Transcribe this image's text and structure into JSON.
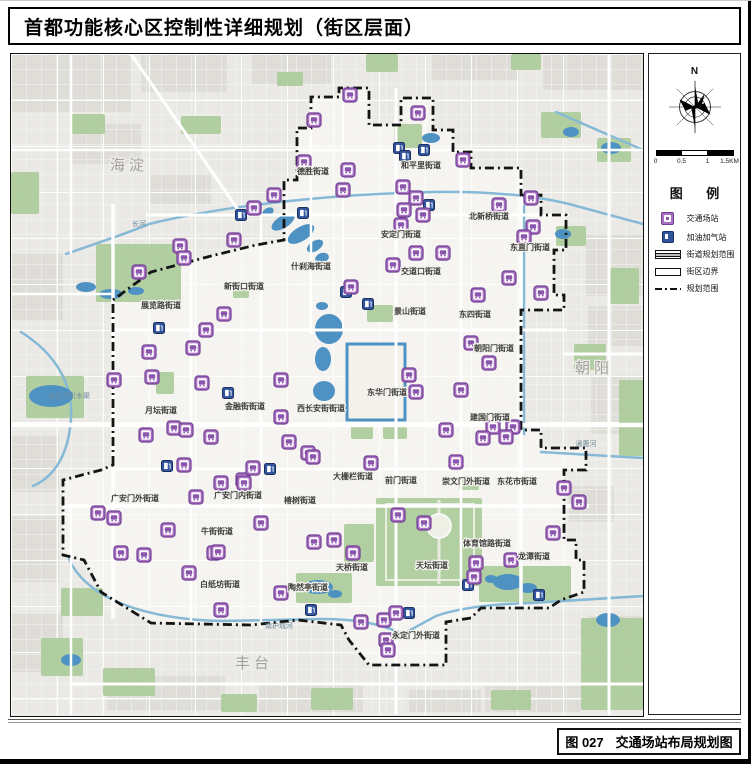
{
  "title": "首都功能核心区控制性详细规划（街区层面）",
  "caption": {
    "figure_no": "图 027",
    "figure_title": "交通场站布局规划图"
  },
  "panel": {
    "north_label": "N",
    "scale_labels": [
      "0",
      "0.5",
      "1",
      "1.5KM"
    ],
    "legend_title": "图 例",
    "legend_items": [
      {
        "swatch": "station",
        "label": "交通场站"
      },
      {
        "swatch": "gas",
        "label": "加油加气站"
      },
      {
        "swatch": "band",
        "label": "街道规划范围"
      },
      {
        "swatch": "outline",
        "label": "街区边界"
      },
      {
        "swatch": "dashdot",
        "label": "规划范围"
      }
    ]
  },
  "map": {
    "colors": {
      "bg": "#eae9e5",
      "inner": "#f5f4f1",
      "block": "#dfddd8",
      "park": "#abcb9b",
      "water": "#4e92c3",
      "river": "#85b9d6",
      "road": "#ffffff",
      "boundary": "#141414",
      "station_fill": "#a96fc0",
      "station_stroke": "#6f3f94",
      "station_glyph": "#8a56ab",
      "gas_fill": "#32549c",
      "gas_stroke": "#1b2f62",
      "street_label": "#3c3c38",
      "district_label": "#a3a19c",
      "water_label": "#6e8a9a"
    },
    "district_labels": [
      {
        "text": "海淀",
        "x": 118,
        "y": 116
      },
      {
        "text": "朝阳",
        "x": 583,
        "y": 319
      },
      {
        "text": "丰台",
        "x": 243,
        "y": 614
      }
    ],
    "water_labels": [
      {
        "text": "长河",
        "x": 128,
        "y": 172
      },
      {
        "text": "永定河引水渠",
        "x": 58,
        "y": 344
      },
      {
        "text": "通惠河",
        "x": 575,
        "y": 392
      },
      {
        "text": "南护城河",
        "x": 268,
        "y": 574
      }
    ],
    "street_labels": [
      {
        "text": "德胜街道",
        "x": 302,
        "y": 120
      },
      {
        "text": "和平里街道",
        "x": 410,
        "y": 114
      },
      {
        "text": "新街口街道",
        "x": 233,
        "y": 235
      },
      {
        "text": "安定门街道",
        "x": 390,
        "y": 183
      },
      {
        "text": "交道口街道",
        "x": 410,
        "y": 220
      },
      {
        "text": "北新桥街道",
        "x": 478,
        "y": 165
      },
      {
        "text": "东直门街道",
        "x": 519,
        "y": 196
      },
      {
        "text": "什刹海街道",
        "x": 300,
        "y": 215
      },
      {
        "text": "景山街道",
        "x": 399,
        "y": 260
      },
      {
        "text": "东四街道",
        "x": 464,
        "y": 263
      },
      {
        "text": "朝阳门街道",
        "x": 483,
        "y": 297
      },
      {
        "text": "东华门街道",
        "x": 376,
        "y": 341
      },
      {
        "text": "西长安街街道",
        "x": 310,
        "y": 357
      },
      {
        "text": "金融街街道",
        "x": 234,
        "y": 355
      },
      {
        "text": "月坛街道",
        "x": 150,
        "y": 359
      },
      {
        "text": "展览路街道",
        "x": 150,
        "y": 254
      },
      {
        "text": "建国门街道",
        "x": 479,
        "y": 366
      },
      {
        "text": "大栅栏街道",
        "x": 342,
        "y": 425
      },
      {
        "text": "前门街道",
        "x": 390,
        "y": 429
      },
      {
        "text": "崇文门外街道",
        "x": 455,
        "y": 430
      },
      {
        "text": "东花市街道",
        "x": 506,
        "y": 430
      },
      {
        "text": "广安门外街道",
        "x": 124,
        "y": 447
      },
      {
        "text": "广安门内街道",
        "x": 227,
        "y": 444
      },
      {
        "text": "椿树街道",
        "x": 289,
        "y": 449
      },
      {
        "text": "牛街街道",
        "x": 206,
        "y": 480
      },
      {
        "text": "陶然亭街道",
        "x": 297,
        "y": 536
      },
      {
        "text": "白纸坊街道",
        "x": 209,
        "y": 533
      },
      {
        "text": "天桥街道",
        "x": 341,
        "y": 516
      },
      {
        "text": "天坛街道",
        "x": 421,
        "y": 514
      },
      {
        "text": "体育馆路街道",
        "x": 476,
        "y": 492
      },
      {
        "text": "龙潭街道",
        "x": 523,
        "y": 505
      },
      {
        "text": "永定门外街道",
        "x": 405,
        "y": 584
      }
    ],
    "station_icons": [
      [
        339,
        41
      ],
      [
        303,
        66
      ],
      [
        407,
        59
      ],
      [
        293,
        108
      ],
      [
        337,
        116
      ],
      [
        452,
        106
      ],
      [
        488,
        151
      ],
      [
        520,
        144
      ],
      [
        522,
        173
      ],
      [
        513,
        183
      ],
      [
        498,
        224
      ],
      [
        530,
        239
      ],
      [
        263,
        141
      ],
      [
        243,
        154
      ],
      [
        223,
        186
      ],
      [
        169,
        192
      ],
      [
        173,
        204
      ],
      [
        128,
        218
      ],
      [
        213,
        260
      ],
      [
        195,
        276
      ],
      [
        182,
        294
      ],
      [
        138,
        298
      ],
      [
        141,
        323
      ],
      [
        103,
        326
      ],
      [
        191,
        329
      ],
      [
        332,
        136
      ],
      [
        392,
        133
      ],
      [
        405,
        144
      ],
      [
        393,
        156
      ],
      [
        412,
        161
      ],
      [
        390,
        171
      ],
      [
        405,
        199
      ],
      [
        432,
        199
      ],
      [
        382,
        211
      ],
      [
        340,
        233
      ],
      [
        467,
        241
      ],
      [
        460,
        289
      ],
      [
        478,
        309
      ],
      [
        450,
        336
      ],
      [
        435,
        376
      ],
      [
        482,
        373
      ],
      [
        502,
        373
      ],
      [
        472,
        384
      ],
      [
        495,
        383
      ],
      [
        270,
        326
      ],
      [
        398,
        321
      ],
      [
        405,
        338
      ],
      [
        270,
        363
      ],
      [
        297,
        399
      ],
      [
        302,
        403
      ],
      [
        135,
        381
      ],
      [
        163,
        374
      ],
      [
        175,
        376
      ],
      [
        200,
        383
      ],
      [
        278,
        388
      ],
      [
        173,
        411
      ],
      [
        210,
        429
      ],
      [
        232,
        426
      ],
      [
        185,
        443
      ],
      [
        87,
        459
      ],
      [
        103,
        464
      ],
      [
        157,
        476
      ],
      [
        110,
        499
      ],
      [
        133,
        501
      ],
      [
        203,
        499
      ],
      [
        242,
        414
      ],
      [
        233,
        429
      ],
      [
        250,
        469
      ],
      [
        207,
        498
      ],
      [
        178,
        519
      ],
      [
        210,
        556
      ],
      [
        270,
        539
      ],
      [
        303,
        488
      ],
      [
        323,
        486
      ],
      [
        342,
        499
      ],
      [
        360,
        409
      ],
      [
        387,
        461
      ],
      [
        413,
        469
      ],
      [
        445,
        408
      ],
      [
        553,
        434
      ],
      [
        568,
        448
      ],
      [
        542,
        479
      ],
      [
        500,
        506
      ],
      [
        465,
        509
      ],
      [
        463,
        523
      ],
      [
        350,
        568
      ],
      [
        373,
        566
      ],
      [
        385,
        559
      ],
      [
        375,
        586
      ],
      [
        377,
        596
      ]
    ],
    "gas_icons": [
      [
        230,
        161
      ],
      [
        292,
        159
      ],
      [
        388,
        94
      ],
      [
        394,
        102
      ],
      [
        413,
        96
      ],
      [
        418,
        151
      ],
      [
        148,
        274
      ],
      [
        217,
        339
      ],
      [
        156,
        412
      ],
      [
        259,
        415
      ],
      [
        335,
        238
      ],
      [
        357,
        250
      ],
      [
        300,
        556
      ],
      [
        398,
        559
      ],
      [
        457,
        531
      ],
      [
        528,
        541
      ]
    ],
    "boundary_path": "M 102,411 L 102,246 L 140,218 L 200,202 L 245,191 L 273,186 L 273,126 L 286,126 L 286,74 L 300,74 L 300,43 L 328,43 L 328,34 L 358,34 L 358,71 L 390,71 L 390,44 L 422,44 L 422,76 L 442,76 L 442,98 L 460,98 L 460,114 L 510,114 L 510,141 L 530,141 L 530,161 L 555,161 L 555,196 L 543,196 L 543,241 L 553,241 L 553,256 L 510,256 L 510,376 L 530,376 L 530,394 L 575,394 L 575,416 L 553,416 L 553,486 L 565,486 L 565,506 L 573,506 L 573,538 L 550,546 L 538,554 L 470,554 L 460,564 L 435,568 L 435,611 L 358,611 L 338,586 L 330,571 L 287,566 L 240,571 L 140,569 L 90,538 L 73,506 L 52,501 L 52,426 L 90,416 Z",
    "roads": [
      {
        "d": "M 0,371 H 632",
        "w": 4.5
      },
      {
        "d": "M 102,276 H 555",
        "w": 3
      },
      {
        "d": "M 52,452 H 578",
        "w": 3.5
      },
      {
        "d": "M 102,415 H 553",
        "w": 2.5
      },
      {
        "d": "M 135,161 H 558",
        "w": 3
      },
      {
        "d": "M 0,96 H 632",
        "w": 2.5
      },
      {
        "d": "M 0,240 H 102",
        "w": 2.5
      },
      {
        "d": "M 60,630 H 632",
        "w": 3
      },
      {
        "d": "M 553,300 H 632",
        "w": 3
      },
      {
        "d": "M 102,150 V 565",
        "w": 3.5
      },
      {
        "d": "M 510,114 V 556",
        "w": 3.5
      },
      {
        "d": "M 385,34 V 660",
        "w": 3
      },
      {
        "d": "M 250,160 V 575",
        "w": 2.5
      },
      {
        "d": "M 450,114 V 562",
        "w": 2.5
      },
      {
        "d": "M 300,43 V 280",
        "w": 2.5
      },
      {
        "d": "M 180,200 V 572",
        "w": 2.5
      },
      {
        "d": "M 60,0 V 200",
        "w": 2.5
      },
      {
        "d": "M 598,0 V 660",
        "w": 3
      },
      {
        "d": "M 60,452 V 660",
        "w": 2.5
      },
      {
        "d": "M 332,276 V 43",
        "w": 2
      },
      {
        "d": "M 120,0 L 230,160",
        "w": 3
      }
    ],
    "rivers": [
      {
        "d": "M 55,200 C 95,186 120,178 138,170 C 220,150 330,140 420,138 C 480,137 525,142 558,150 L 632,170"
      },
      {
        "d": "M 58,505 C 75,543 130,565 210,567 L 310,565 C 350,565 372,571 392,580 L 425,562 C 448,554 480,550 520,549 L 632,542"
      },
      {
        "d": "M 530,398 L 632,404"
      },
      {
        "d": "M 10,278 C 45,300 62,330 60,364 C 58,398 45,422 22,432"
      },
      {
        "d": "M 513,152 L 513,380"
      },
      {
        "d": "M 545,58 L 632,96"
      }
    ],
    "parks": [
      [
        365,
        444,
        106,
        88
      ],
      [
        468,
        512,
        92,
        36
      ],
      [
        285,
        519,
        56,
        30
      ],
      [
        333,
        470,
        30,
        38
      ],
      [
        340,
        370,
        22,
        15
      ],
      [
        372,
        370,
        24,
        15
      ],
      [
        356,
        251,
        26,
        17
      ],
      [
        383,
        70,
        28,
        24
      ],
      [
        530,
        58,
        40,
        26
      ],
      [
        586,
        84,
        34,
        24
      ],
      [
        545,
        172,
        30,
        20
      ],
      [
        563,
        290,
        32,
        26
      ],
      [
        85,
        190,
        85,
        58
      ],
      [
        15,
        322,
        58,
        42
      ],
      [
        145,
        318,
        18,
        22
      ],
      [
        50,
        534,
        42,
        28
      ],
      [
        30,
        584,
        42,
        38
      ],
      [
        92,
        614,
        52,
        28
      ],
      [
        300,
        634,
        42,
        22
      ],
      [
        570,
        564,
        62,
        92
      ],
      [
        608,
        326,
        24,
        76
      ],
      [
        210,
        640,
        36,
        18
      ],
      [
        480,
        636,
        40,
        20
      ],
      [
        355,
        0,
        32,
        18
      ],
      [
        170,
        62,
        40,
        18
      ],
      [
        0,
        118,
        28,
        42
      ],
      [
        598,
        214,
        30,
        36
      ],
      [
        448,
        424,
        20,
        12
      ],
      [
        222,
        234,
        16,
        10
      ],
      [
        60,
        60,
        34,
        20
      ],
      [
        266,
        18,
        26,
        14
      ],
      [
        500,
        0,
        30,
        16
      ]
    ],
    "lakes": [
      [
        272,
        168,
        13,
        6,
        -32
      ],
      [
        290,
        180,
        15,
        7,
        -32
      ],
      [
        304,
        192,
        9,
        5,
        -32
      ],
      [
        311,
        204,
        7,
        5,
        -20
      ],
      [
        311,
        252,
        6,
        4,
        0
      ],
      [
        318,
        275,
        14,
        15,
        0
      ],
      [
        312,
        305,
        8,
        12,
        0
      ],
      [
        313,
        337,
        11,
        10,
        0
      ],
      [
        75,
        233,
        10,
        5,
        0
      ],
      [
        100,
        240,
        12,
        5,
        0
      ],
      [
        125,
        237,
        8,
        4,
        0
      ],
      [
        40,
        342,
        22,
        11,
        0
      ],
      [
        560,
        78,
        8,
        5,
        0
      ],
      [
        600,
        94,
        10,
        6,
        0
      ],
      [
        552,
        180,
        8,
        5,
        0
      ],
      [
        420,
        84,
        9,
        5,
        0
      ],
      [
        497,
        528,
        15,
        8,
        0
      ],
      [
        517,
        534,
        9,
        5,
        0
      ],
      [
        480,
        525,
        6,
        4,
        0
      ],
      [
        307,
        533,
        15,
        7,
        0
      ],
      [
        324,
        540,
        7,
        4,
        0
      ],
      [
        257,
        158,
        6,
        4,
        -30
      ],
      [
        597,
        566,
        12,
        7,
        0
      ],
      [
        60,
        606,
        10,
        6,
        0
      ]
    ],
    "moat": {
      "x": 336,
      "y": 290,
      "w": 58,
      "h": 76
    },
    "tiantan": {
      "circle": [
        428,
        472,
        12
      ],
      "axis": "M 428,446 V 530",
      "inner_rect": [
        375,
        450,
        88,
        76
      ]
    },
    "blocks": [
      [
        575,
        180,
        57,
        62
      ],
      [
        577,
        252,
        55,
        40
      ],
      [
        580,
        322,
        52,
        58
      ],
      [
        558,
        432,
        45,
        36
      ],
      [
        577,
        562,
        55,
        70
      ],
      [
        0,
        0,
        120,
        58
      ],
      [
        130,
        0,
        86,
        38
      ],
      [
        240,
        0,
        80,
        30
      ],
      [
        420,
        0,
        88,
        26
      ],
      [
        532,
        0,
        100,
        36
      ],
      [
        0,
        200,
        52,
        66
      ],
      [
        0,
        382,
        48,
        56
      ],
      [
        0,
        462,
        48,
        66
      ],
      [
        0,
        560,
        52,
        58
      ],
      [
        96,
        622,
        118,
        34
      ],
      [
        248,
        630,
        104,
        28
      ],
      [
        398,
        636,
        72,
        22
      ],
      [
        474,
        632,
        96,
        26
      ],
      [
        60,
        70,
        70,
        40
      ],
      [
        140,
        120,
        60,
        30
      ]
    ]
  }
}
